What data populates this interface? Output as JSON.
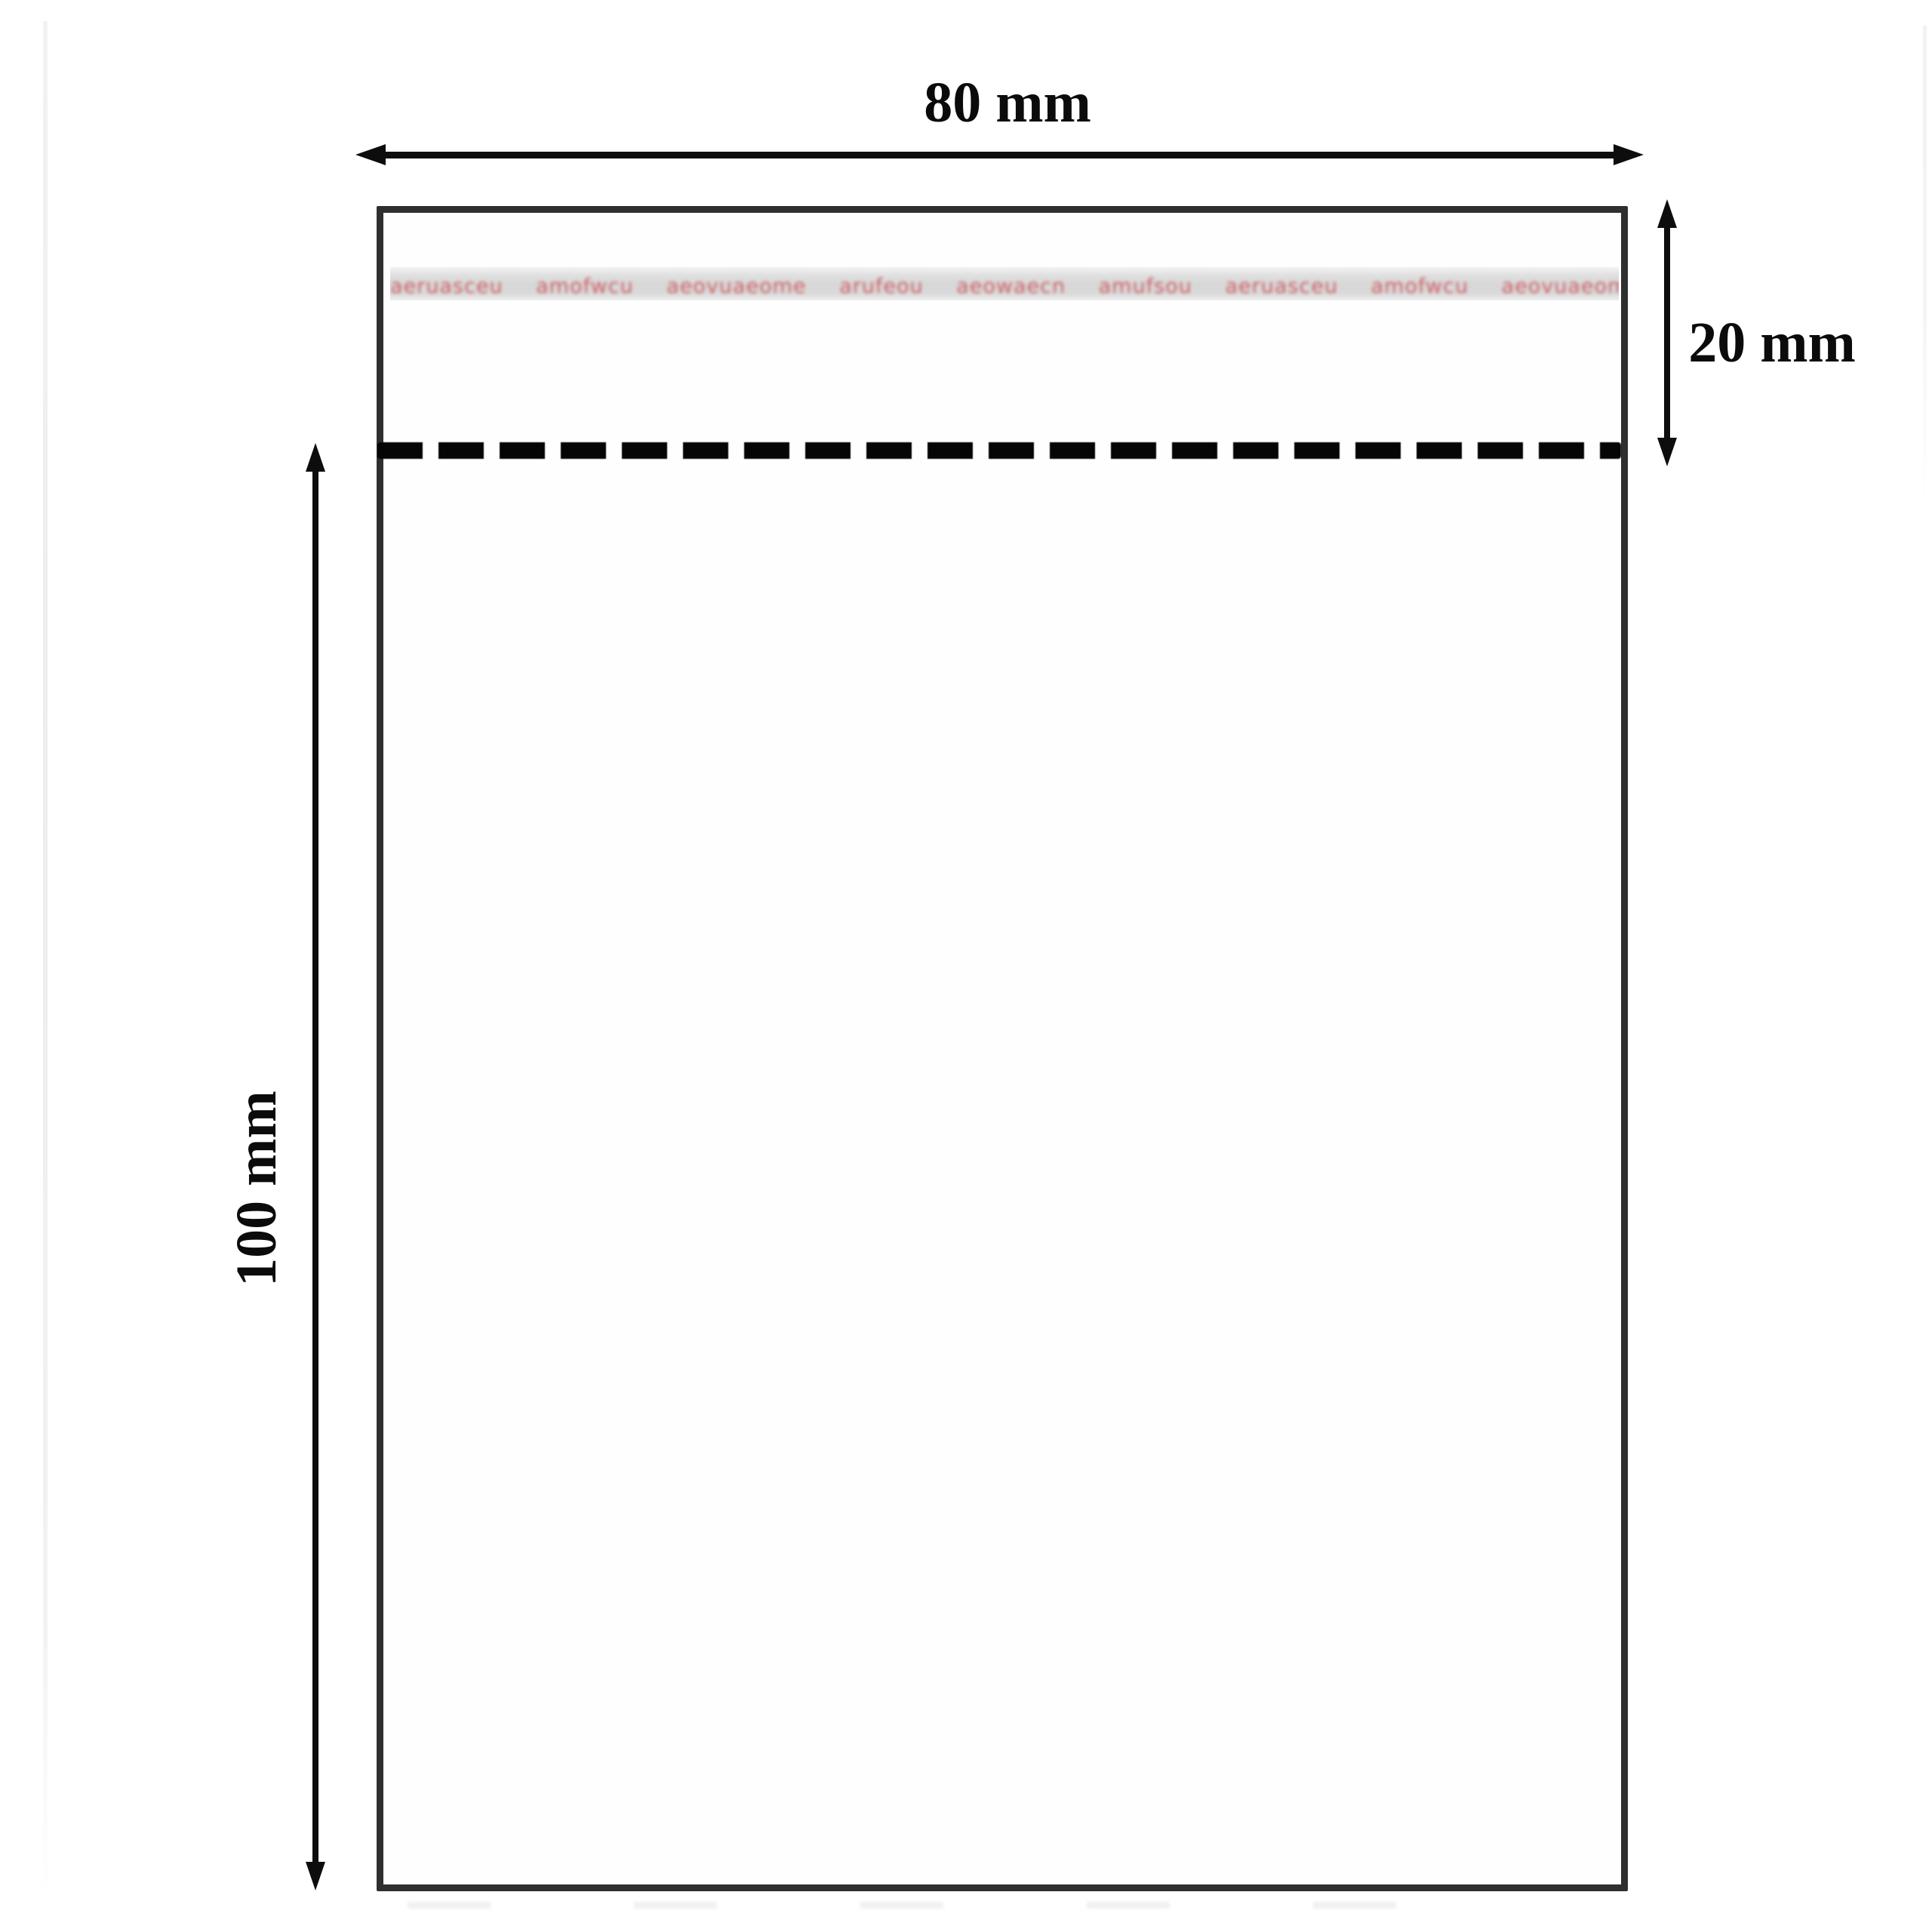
{
  "diagram": {
    "subject": "self-seal transparent bag with adhesive flap, dimension drawing",
    "dimensions": {
      "width_label": "80 mm",
      "flap_label": "20 mm",
      "body_label": "100 mm"
    },
    "adhesive_strip": {
      "print_text": "aeruasceu amofwcu aeovuaeome arufeou aeowaecn amufsou aeruasceu amofwcu aeovuaeome arufeou aeowaecn amufsou aeo"
    },
    "icons": {
      "width_arrow": "double-headed-horizontal-arrow",
      "flap_arrow": "double-headed-vertical-arrow",
      "body_arrow": "double-headed-vertical-arrow",
      "fold_line": "horizontal-dashed-fold-line"
    },
    "colors": {
      "outline": "#2f2f2f",
      "dimension_lines": "#0d0d0d",
      "strip_background": "#d9d9d9",
      "strip_print": "#cc5a60",
      "background": "#ffffff"
    }
  }
}
